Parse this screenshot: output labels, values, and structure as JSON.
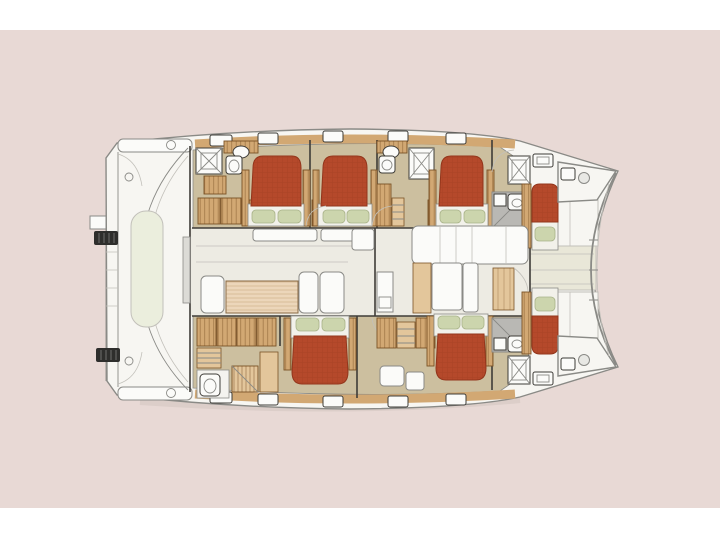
{
  "document": {
    "type": "catamaran-deck-plan",
    "view": "top-down floor plan",
    "bow_direction": "right",
    "stern_direction": "left"
  },
  "counts": {
    "double_bed_cabins": 5,
    "single_bow_berths": 2,
    "toilets": 5,
    "sinks": 4,
    "shower_stalls": 4,
    "dinette_tables": 1
  },
  "colors": {
    "page_band": "#ffffff",
    "backdrop": "#e8d9d5",
    "deck_white": "#f7f6f2",
    "cream_deck": "#e9e7d8",
    "pale_bench": "#ebeedd",
    "floor_tan": "#ccbf9f",
    "salon_floor": "#edebe3",
    "wood": "#d2a873",
    "wood_light": "#e3c69b",
    "wood_dark": "#7a5226",
    "table_wood": "#ecd6ba",
    "table_slat": "#c9a87e",
    "bed_red": "#b5492b",
    "bed_red_dark": "#93361c",
    "pillow_green": "#ccd5ad",
    "pillow_edge": "#a8b289",
    "mattress_white": "#f2f1ea",
    "shower_gray": "#b9b8b4",
    "line_dark": "#3e3c38",
    "line_mid": "#8a8a86",
    "line_light": "#c2c0ba",
    "fixture_white": "#fbfbf9",
    "cleat_dark": "#2e2e2c",
    "shadow": "#cfc3be"
  }
}
